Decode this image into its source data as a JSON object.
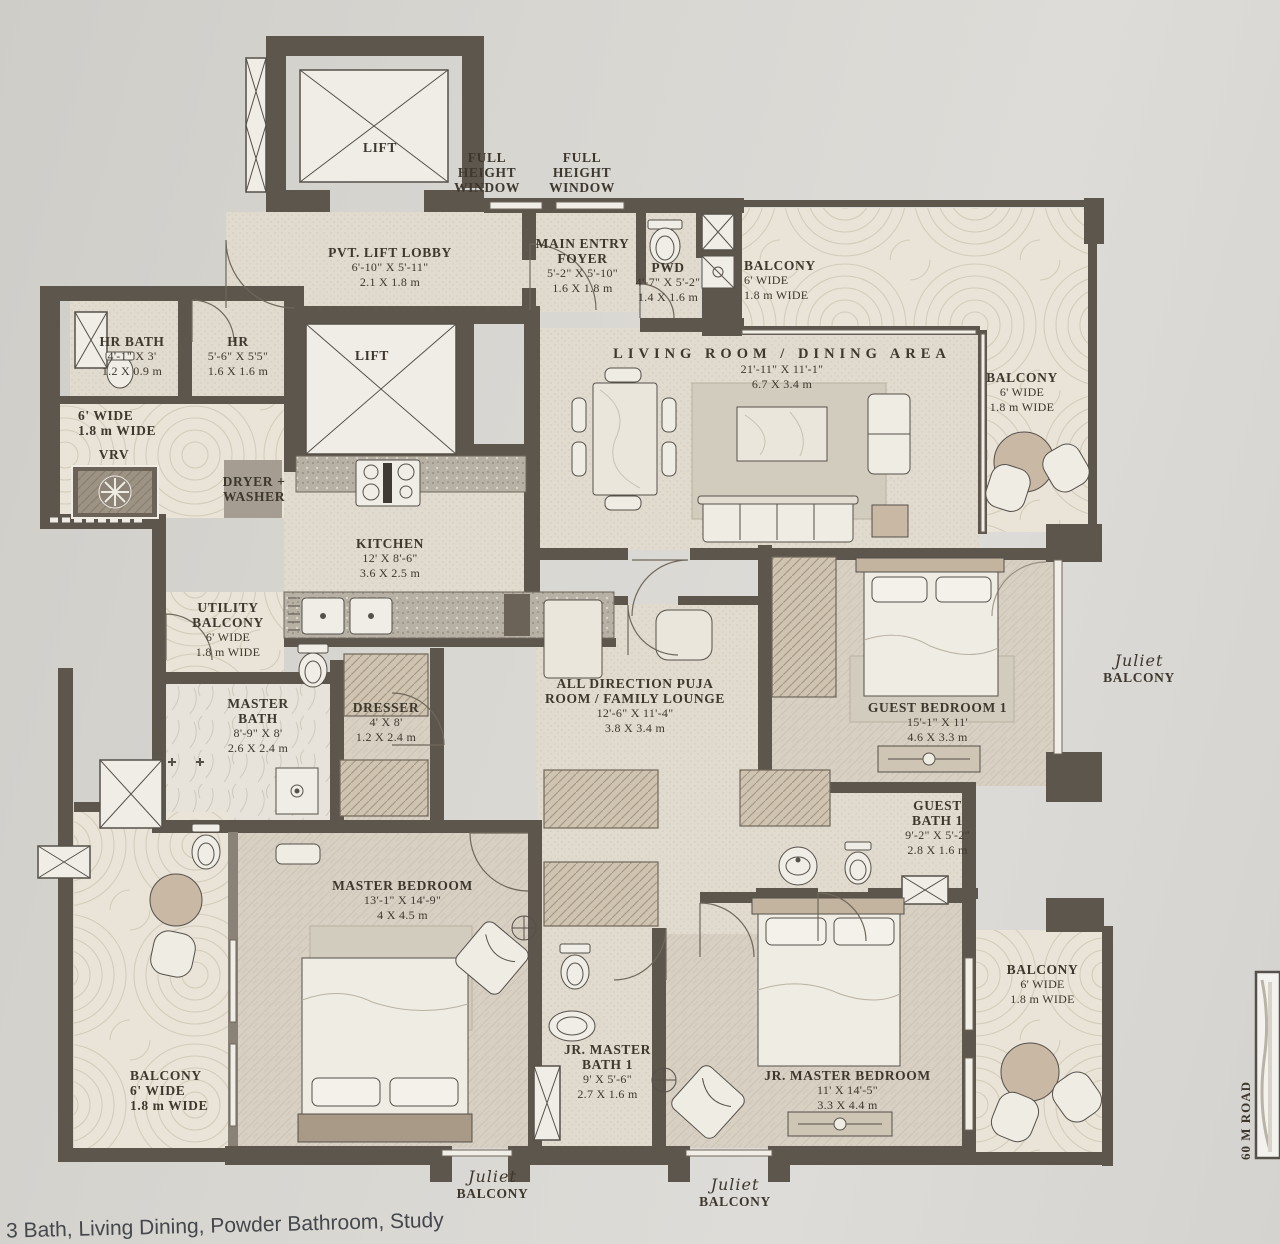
{
  "labels": {
    "lift_top": {
      "l1": "LIFT"
    },
    "lift_mid": {
      "l1": "LIFT"
    },
    "window1": {
      "l1": "FULL",
      "l2": "HEIGHT",
      "l3": "WINDOW"
    },
    "window2": {
      "l1": "FULL",
      "l2": "HEIGHT",
      "l3": "WINDOW"
    },
    "lobby": {
      "l1": "PVT. LIFT LOBBY",
      "l2": "6'-10\" X 5'-11\"",
      "l3": "2.1 X 1.8 m"
    },
    "foyer": {
      "l1": "MAIN ENTRY",
      "l2": "FOYER",
      "l3": "5'-2\" X 5'-10\"",
      "l4": "1.6 X 1.8 m"
    },
    "pwd": {
      "l1": "PWD",
      "l2": "4'-7\" X 5'-2\"",
      "l3": "1.4 X 1.6 m"
    },
    "balcony_top": {
      "l1": "BALCONY",
      "l2": "6' WIDE",
      "l3": "1.8 m WIDE"
    },
    "living": {
      "l1": "LIVING ROOM / DINING AREA",
      "l2": "21'-11\" X 11'-1\"",
      "l3": "6.7 X 3.4 m"
    },
    "balcony_right": {
      "l1": "BALCONY",
      "l2": "6' WIDE",
      "l3": "1.8 m WIDE"
    },
    "hr_bath": {
      "l1": "HR BATH",
      "l2": "4'-1\" X 3'",
      "l3": "1.2 X 0.9 m"
    },
    "hr": {
      "l1": "HR",
      "l2": "5'-6\" X 5'5\"",
      "l3": "1.6 X 1.6 m"
    },
    "balcony_left": {
      "l1": "6' WIDE",
      "l2": "1.8 m WIDE"
    },
    "vrv": {
      "l1": "VRV"
    },
    "dryer": {
      "l1": "DRYER +",
      "l2": "WASHER"
    },
    "kitchen": {
      "l1": "KITCHEN",
      "l2": "12' X 8'-6\"",
      "l3": "3.6 X 2.5 m"
    },
    "utility": {
      "l1": "UTILITY",
      "l2": "BALCONY",
      "l3": "6' WIDE",
      "l4": "1.8 m WIDE"
    },
    "master_bath": {
      "l1": "MASTER",
      "l2": "BATH",
      "l3": "8'-9\" X 8'",
      "l4": "2.6 X 2.4 m"
    },
    "dresser": {
      "l1": "DRESSER",
      "l2": "4' X 8'",
      "l3": "1.2 X 2.4 m"
    },
    "puja": {
      "l1": "ALL DIRECTION PUJA",
      "l2": "ROOM / FAMILY LOUNGE",
      "l3": "12'-6\" X 11'-4\"",
      "l4": "3.8 X 3.4 m"
    },
    "guest_bedroom": {
      "l1": "GUEST BEDROOM 1",
      "l2": "15'-1\" X 11'",
      "l3": "4.6 X 3.3 m"
    },
    "guest_bath": {
      "l1": "GUEST",
      "l2": "BATH 1",
      "l3": "9'-2\" X 5'-2\"",
      "l4": "2.8 X 1.6 m"
    },
    "master_bedroom": {
      "l1": "MASTER BEDROOM",
      "l2": "13'-1\" X 14'-9\"",
      "l3": "4 X 4.5 m"
    },
    "jr_bath": {
      "l1": "JR. MASTER",
      "l2": "BATH 1",
      "l3": "9' X 5'-6\"",
      "l4": "2.7 X 1.6 m"
    },
    "jr_bedroom": {
      "l1": "JR. MASTER BEDROOM",
      "l2": "11' X 14'-5\"",
      "l3": "3.3 X 4.4 m"
    },
    "balcony_br": {
      "l1": "BALCONY",
      "l2": "6' WIDE",
      "l3": "1.8 m WIDE"
    },
    "balcony_bl": {
      "l1": "BALCONY",
      "l2": "6' WIDE",
      "l3": "1.8 m WIDE"
    },
    "juliet_right": {
      "script": "Juliet",
      "l1": "BALCONY"
    },
    "juliet_b1": {
      "script": "Juliet",
      "l1": "BALCONY"
    },
    "juliet_b2": {
      "script": "Juliet",
      "l1": "BALCONY"
    }
  },
  "road": "60 M ROAD",
  "caption": "3 Bath, Living Dining, Powder Bathroom, Study"
}
